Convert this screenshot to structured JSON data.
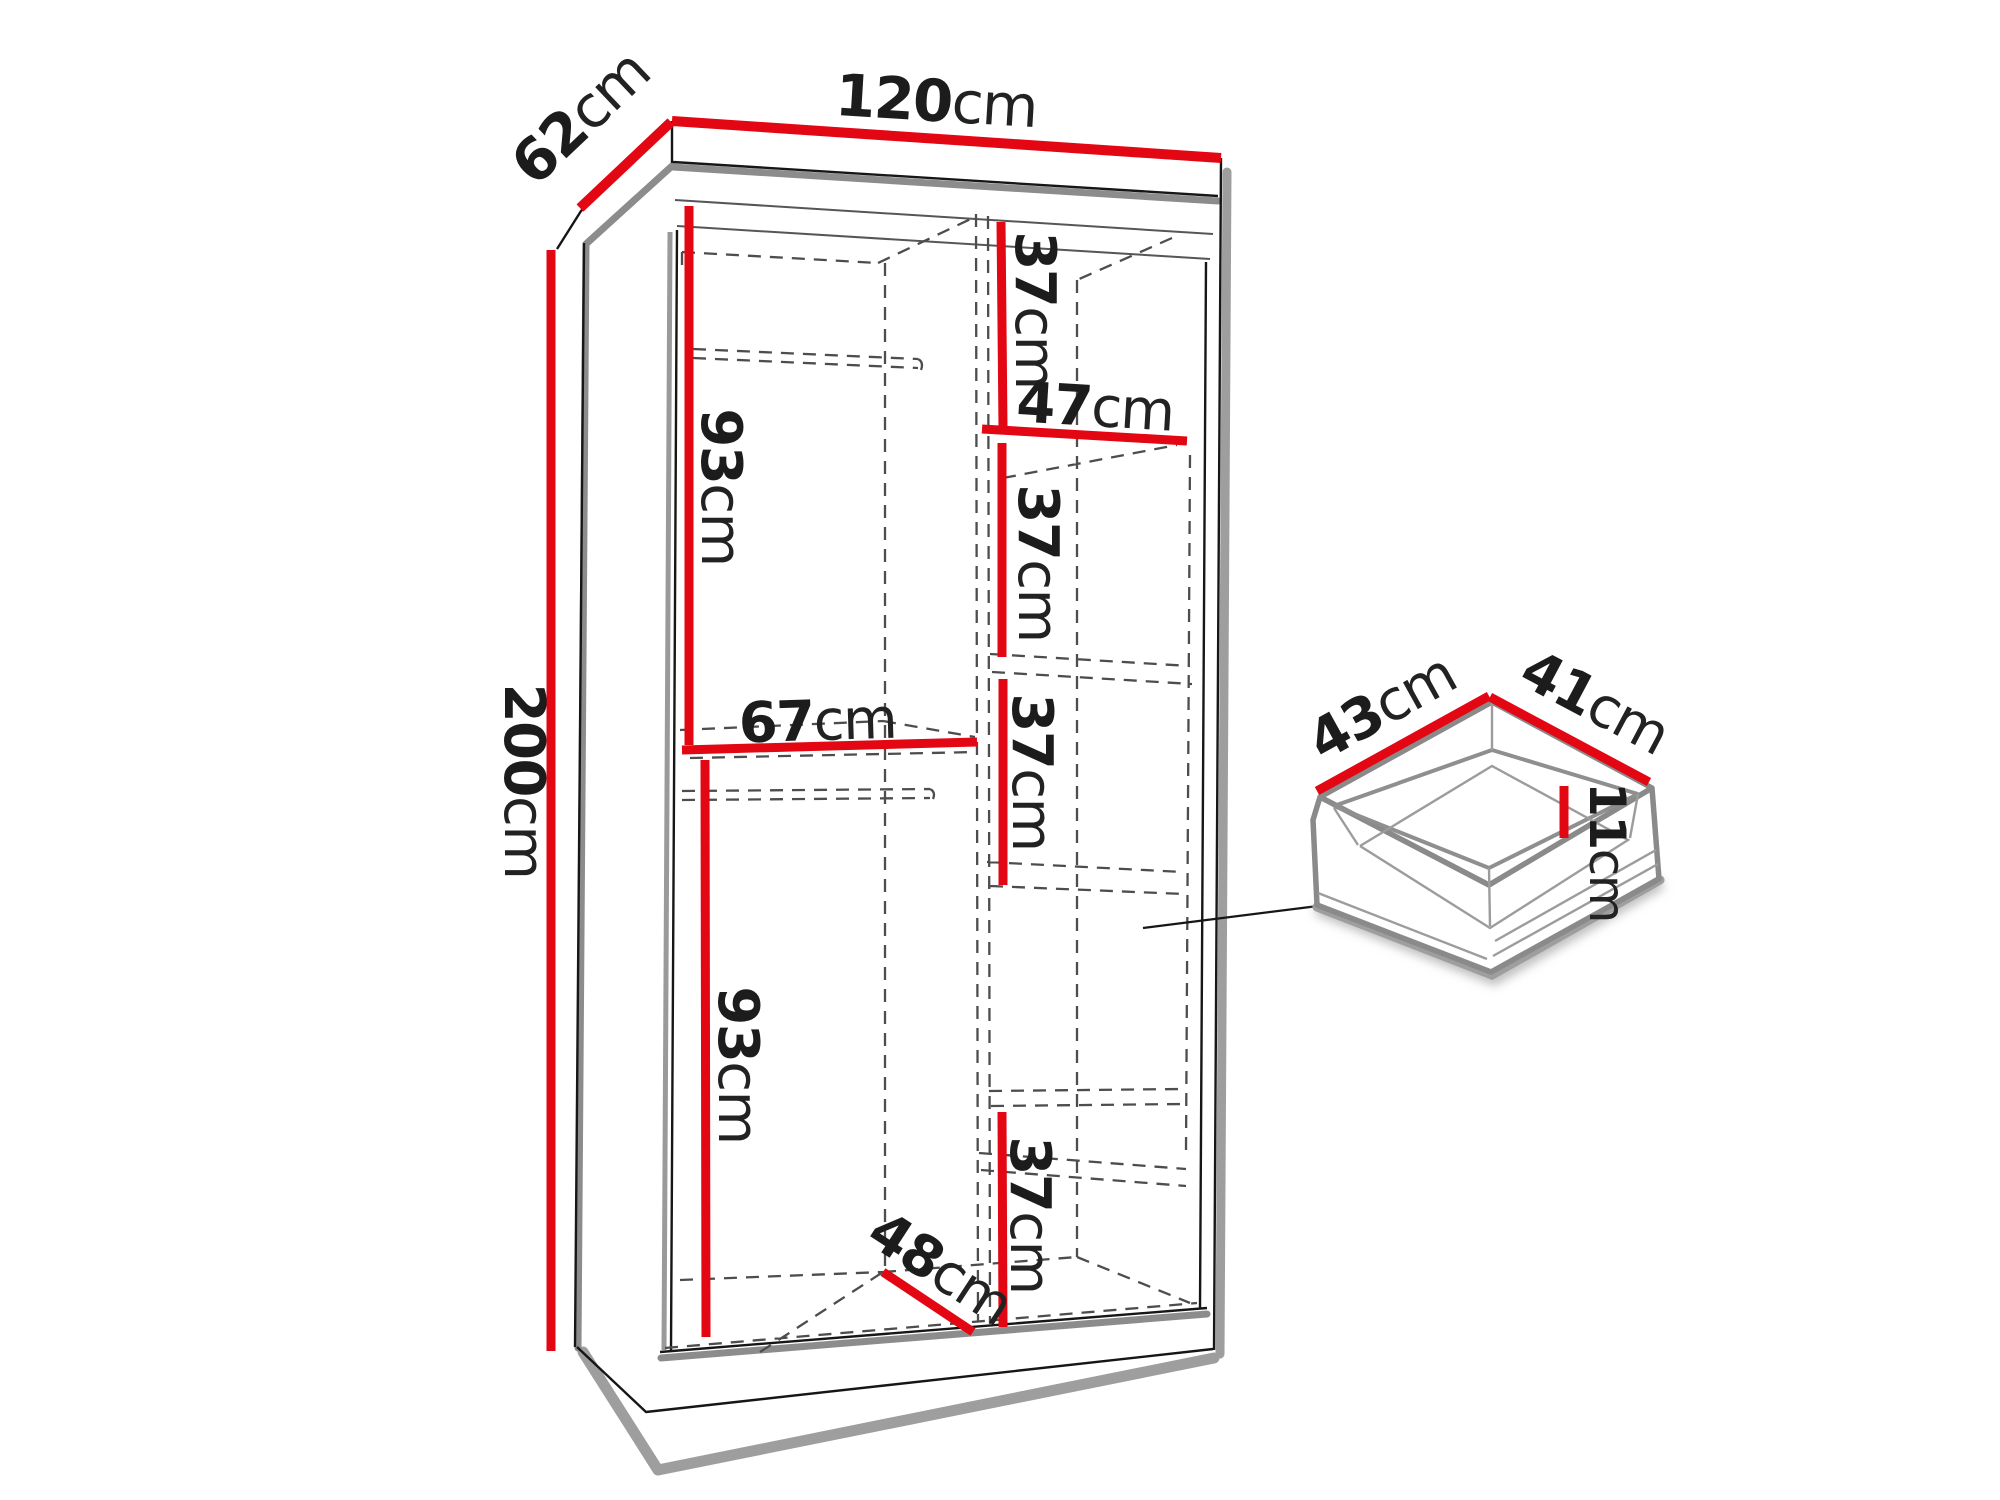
{
  "diagram_title": "wardrobe interior dimensions with drawer detail",
  "dims": {
    "width": {
      "value": "120",
      "unit": "cm"
    },
    "depth": {
      "value": "62",
      "unit": "cm"
    },
    "height": {
      "value": "200",
      "unit": "cm"
    },
    "upper_hanging": {
      "value": "93",
      "unit": "cm"
    },
    "left_section_width": {
      "value": "67",
      "unit": "cm"
    },
    "lower_hanging": {
      "value": "93",
      "unit": "cm"
    },
    "floor_depth": {
      "value": "48",
      "unit": "cm"
    },
    "right_top": {
      "value": "37",
      "unit": "cm"
    },
    "shelf_width": {
      "value": "47",
      "unit": "cm"
    },
    "right_second": {
      "value": "37",
      "unit": "cm"
    },
    "right_third": {
      "value": "37",
      "unit": "cm"
    },
    "right_bottom": {
      "value": "37",
      "unit": "cm"
    },
    "drawer_depth": {
      "value": "43",
      "unit": "cm"
    },
    "drawer_width": {
      "value": "41",
      "unit": "cm"
    },
    "drawer_height": {
      "value": "11",
      "unit": "cm"
    }
  },
  "colors": {
    "dimension_red": "#e30613",
    "outline_black": "#1c1c1c",
    "shade_gray": "#8c8c8c",
    "dash_gray": "#4d4d4d",
    "background": "#ffffff"
  }
}
